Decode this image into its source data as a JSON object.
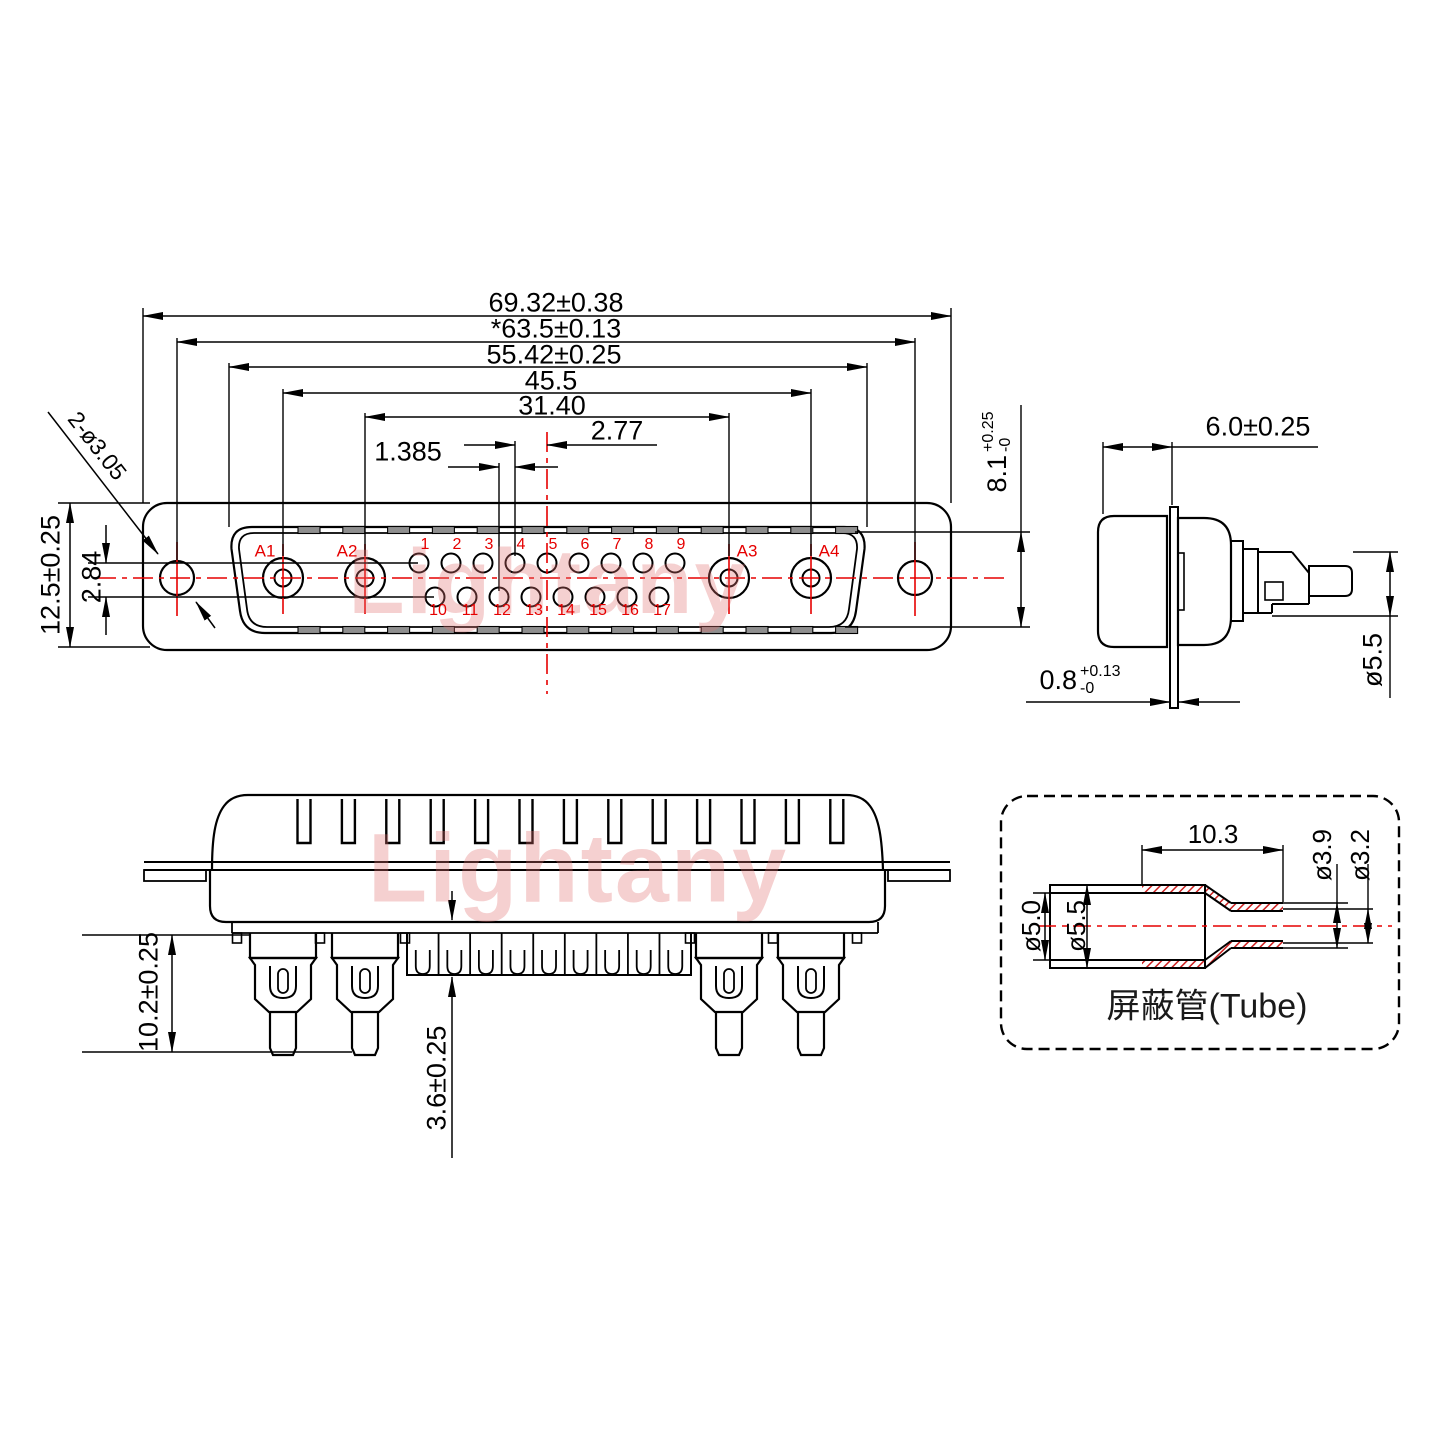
{
  "colors": {
    "line": "#000000",
    "accent_red": "#e60000",
    "hatch_red": "#cc2020",
    "slot_gray": "#8f8f8f",
    "watermark_pink": "rgba(225,112,112,0.33)"
  },
  "watermark": {
    "text": "Lightany"
  },
  "front_view": {
    "dims": {
      "width_outer": "69.32±0.38",
      "width_mount": "*63.5±0.13",
      "width_shroud": "55.42±0.25",
      "width_a_outer": "45.5",
      "width_a_inner": "31.40",
      "pin_pitch": "2.77",
      "half_pitch": "1.385",
      "height": "12.5±0.25",
      "row_gap": "2.84",
      "mount_holes": "2-ø3.05"
    },
    "contacts": [
      "A1",
      "A2",
      "A3",
      "A4"
    ],
    "pins_top": [
      "1",
      "2",
      "3",
      "4",
      "5",
      "6",
      "7",
      "8",
      "9"
    ],
    "pins_bottom": [
      "10",
      "11",
      "12",
      "13",
      "14",
      "15",
      "16",
      "17"
    ]
  },
  "side_view": {
    "dims": {
      "depth": "6.0±0.25",
      "shroud_height": {
        "main": "8.1",
        "plus": "+0.25",
        "minus": "-0"
      },
      "flange_thickness": {
        "main": "0.8",
        "plus": "+0.13",
        "minus": "-0"
      },
      "pin_diameter": "ø5.5"
    }
  },
  "bottom_view": {
    "dims": {
      "tail_length": "10.2±0.25",
      "insulator_height": "3.6±0.25"
    }
  },
  "tube_detail": {
    "title": "屏蔽管(Tube)",
    "dims": {
      "crimp_length": "10.3",
      "neck_outer": "ø3.9",
      "neck_inner": "ø3.2",
      "body_inner": "ø5.0",
      "body_outer": "ø5.5"
    }
  }
}
